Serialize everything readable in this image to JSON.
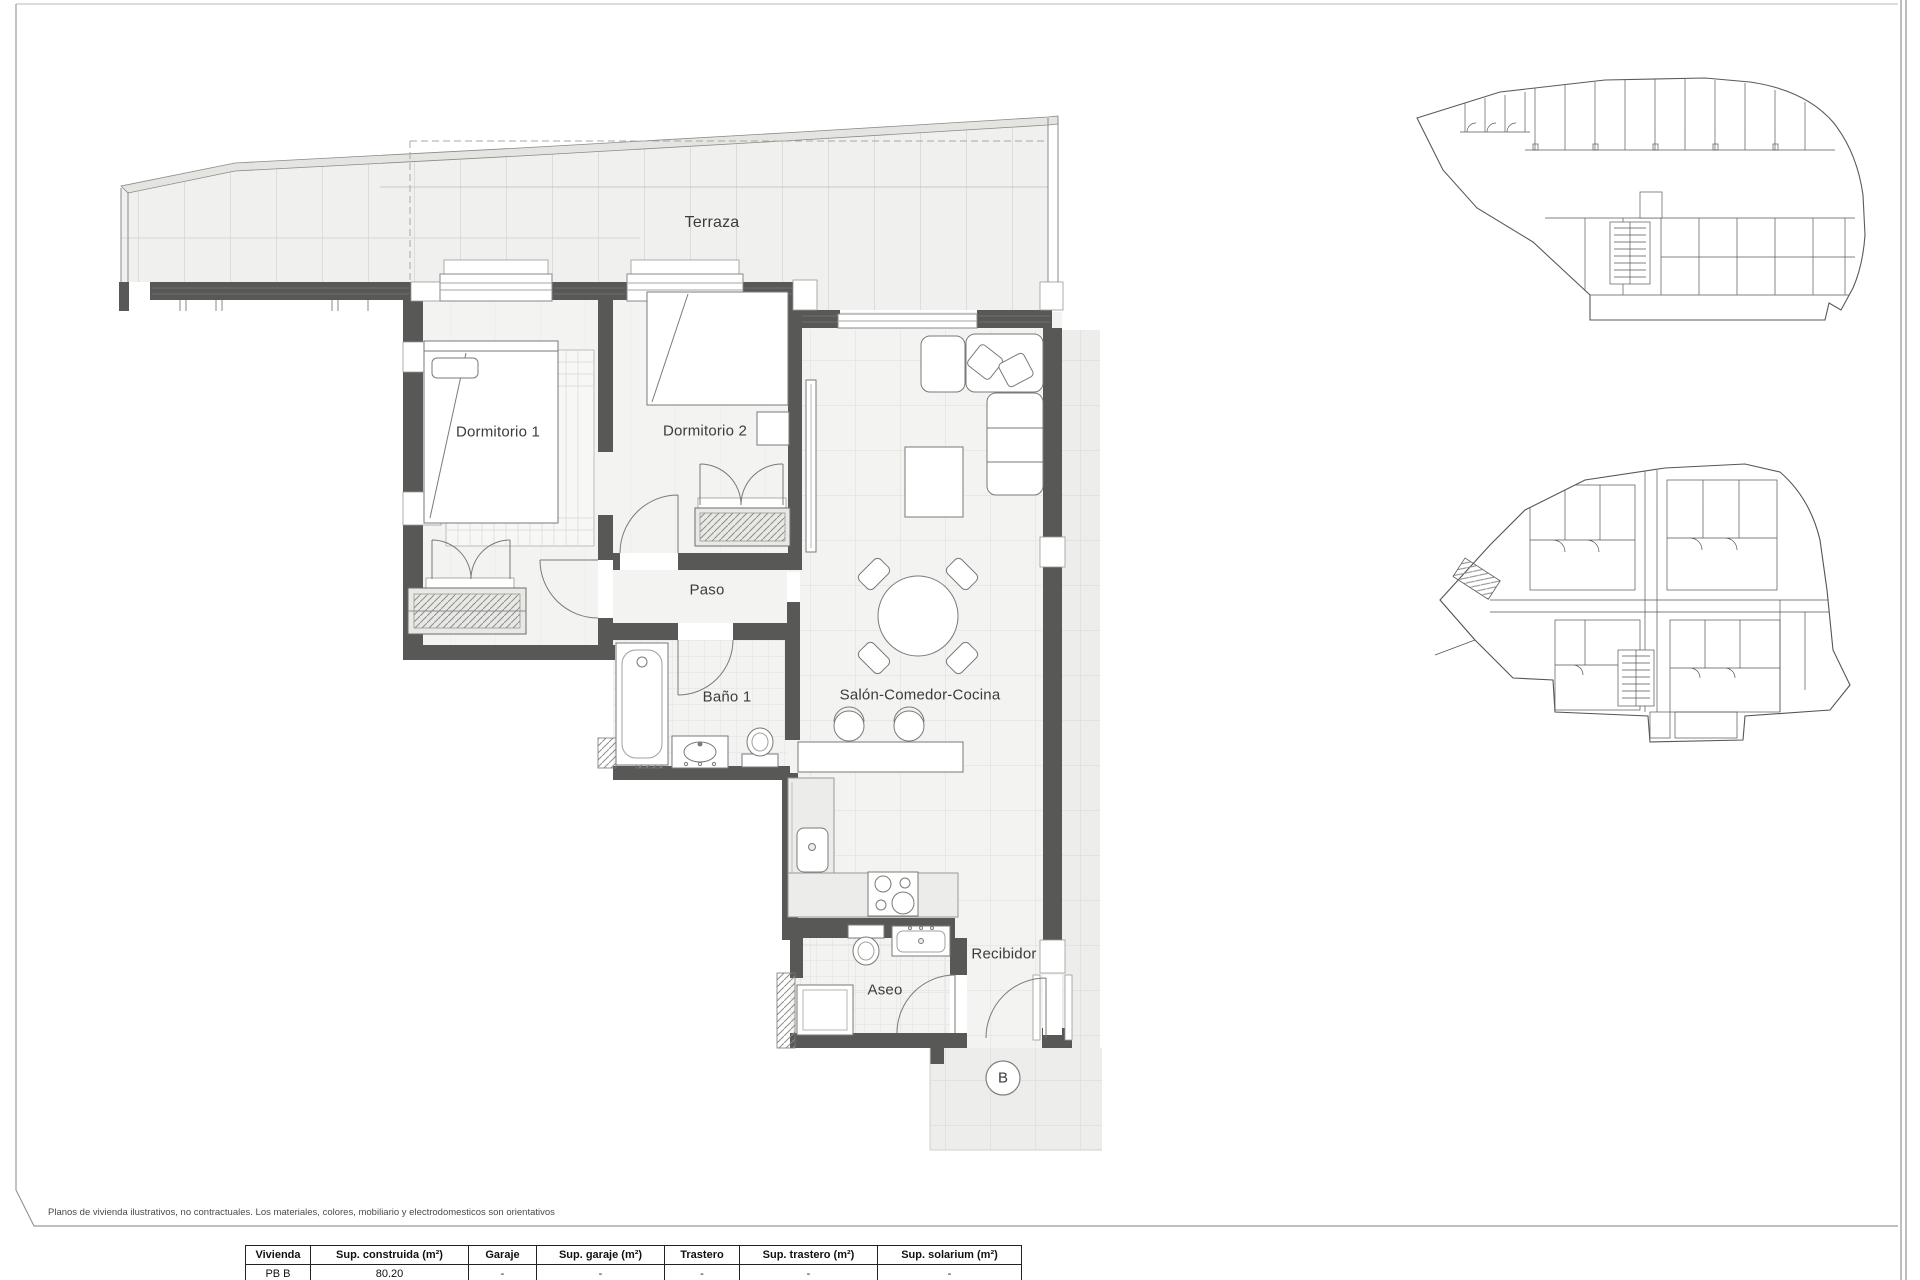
{
  "sheet": {
    "disclaimer": "Planos de vivienda ilustrativos, no contractuales. Los materiales, colores, mobiliario y electrodomesticos son orientativos",
    "unit_marker": "B"
  },
  "plan": {
    "rooms": {
      "terraza": "Terraza",
      "dormitorio1": "Dormitorio 1",
      "dormitorio2": "Dormitorio 2",
      "paso": "Paso",
      "bano1": "Baño 1",
      "salon": "Salón-Comedor-Cocina",
      "aseo": "Aseo",
      "recibidor": "Recibidor"
    },
    "colors": {
      "wall": "#585856",
      "floor": "#f2f2f0",
      "terrace_tile": "#c9c9c7"
    }
  },
  "table": {
    "headers": [
      "Vivienda",
      "Sup. construida (m²)",
      "Garaje",
      "Sup. garaje (m²)",
      "Trastero",
      "Sup. trastero (m²)",
      "Sup. solarium (m²)"
    ],
    "rows": [
      [
        "PB B",
        "80.20",
        "-",
        "-",
        "-",
        "-",
        "-"
      ]
    ]
  }
}
